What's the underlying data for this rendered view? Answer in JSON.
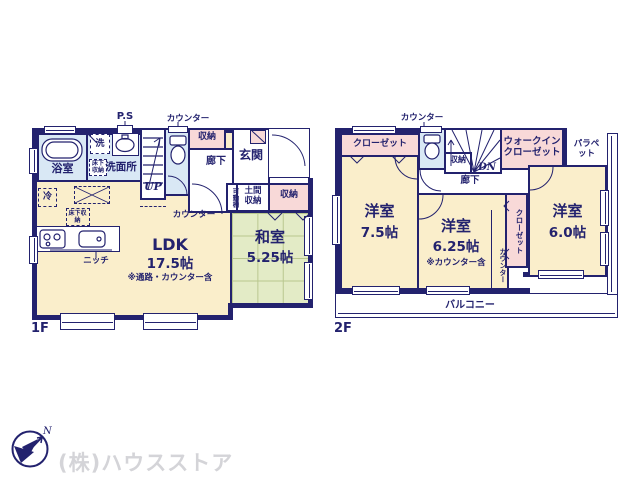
{
  "compass": {
    "n": "N"
  },
  "footer": {
    "company": "(株)ハウスストア"
  },
  "colors": {
    "wall": "#23226e",
    "room_floor": "#faeecb",
    "wet_area": "#d9e8f5",
    "closet": "#f8d9d8",
    "tatami": "#e3ebc6",
    "logo_text": "#d4d4d8"
  },
  "floor1": {
    "label": "1F",
    "bath": "浴室",
    "washer": "洗",
    "ps": "P.S",
    "washroom": "洗面所",
    "underfloor_a": "床下収納",
    "underfloor_b": "床下収納",
    "stairs_up": "UP",
    "counter_top": "カウンター",
    "counter_mid": "カウンター",
    "storage_a": "収納",
    "hallway": "廊下",
    "entrance": "玄関",
    "movable_shelf": "可動棚",
    "entrance_storage": "土間収納",
    "storage_b": "収納",
    "fridge": "冷",
    "niche": "ニッチ",
    "ldk": {
      "name": "LDK",
      "size": "17.5帖",
      "note": "※通路・カウンター含"
    },
    "washitsu": {
      "name": "和室",
      "size": "5.25帖"
    }
  },
  "floor2": {
    "label": "2F",
    "counter_top": "カウンター",
    "closet_a": "クローゼット",
    "stairs_dn": "DN",
    "storage": "収納",
    "wic": "ウォークインクローゼット",
    "parapet": "パラペット",
    "hallway": "廊下",
    "bedroom1": {
      "name": "洋室",
      "size": "7.5帖"
    },
    "bedroom2": {
      "name": "洋室",
      "size": "6.25帖",
      "note": "※カウンター含"
    },
    "counter_side": "カウンター",
    "closet_b": "クローゼット",
    "bedroom3": {
      "name": "洋室",
      "size": "6.0帖"
    },
    "balcony": "バルコニー"
  }
}
